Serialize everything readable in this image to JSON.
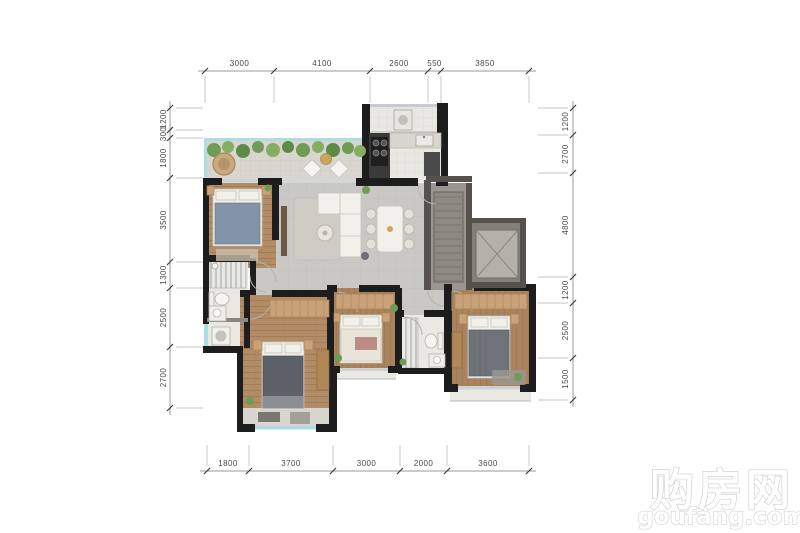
{
  "image_type": "apartment-floor-plan",
  "watermark": {
    "title": "购房网",
    "domain": "goufang.com"
  },
  "dimensions": {
    "top": [
      "3000",
      "4100",
      "2600",
      "550",
      "3850"
    ],
    "bottom": [
      "1800",
      "3700",
      "3000",
      "2000",
      "3600"
    ],
    "left": [
      "1200",
      "300",
      "1800",
      "3500",
      "1300",
      "2500",
      "2700"
    ],
    "right": [
      "1200",
      "2700",
      "4800",
      "1200",
      "2500",
      "1500"
    ]
  },
  "colors": {
    "wall": "#1d1d1d",
    "wood_floor": "#b28c66",
    "tile_floor": "#cac8c4",
    "terrace_floor": "#d8d6ce",
    "white_tile": "#eae8e3",
    "glass": "#aedce3",
    "greenery": "#6f9c55",
    "shaft": "#9a958e",
    "dimension_line": "#9a9a9a",
    "dimension_text": "#4a4a4a",
    "watermark_outline": "#d2d2d2"
  }
}
